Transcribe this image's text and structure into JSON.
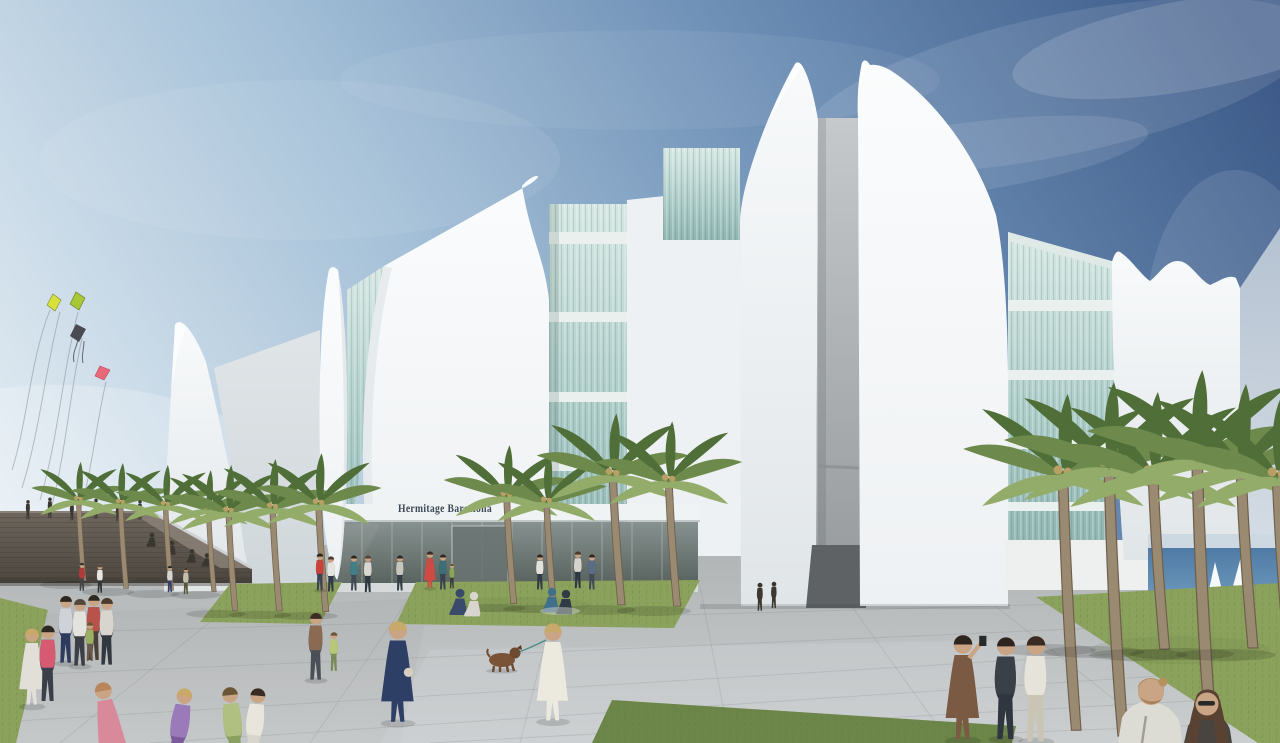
{
  "scene": {
    "type": "architectural-rendering",
    "description": "Architectural rendering of the Hermitage Barcelona museum: white sail-like shells alternating with green glass curtain walls, a palm-lined stone plaza with pedestrians, kites flying at left and the sea with sailboats at right.",
    "building": {
      "sign": "Hermitage Barcelona"
    },
    "details": {
      "kites": "two yellow-green kites, one dark kite, one pink kite with long tails",
      "sailboats": "two white sailboats on blue sea at right",
      "foreground": "woman in navy dress, woman in white dress walking a brown dog, children running, couple in lower right corner"
    }
  },
  "colors": {
    "sky_top": "#3d5a88",
    "sky_upper": "#6b8db4",
    "sky_mid": "#a3bfd7",
    "sky_low": "#e4edf3",
    "shell_light": "#f8fafb",
    "shell_mid": "#eef1f3",
    "shell_shade": "#e0e5e8",
    "shell_dark_side": "#cfd6d9",
    "glass_top": "#d6e7e3",
    "glass_mid": "#aecdc9",
    "glass_deep": "#8fb5b1",
    "slab": "#e9f0ed",
    "slot_top": "#c6c9cb",
    "slot_bottom": "#94989a",
    "recess_dark": "#5e6264",
    "entrance_top": "#87918f",
    "entrance_bottom": "#59635f",
    "fascia": "#f0f3f4",
    "sign_text": "#3c4854",
    "wall_top_c": "#6e665d",
    "wall_bottom_c": "#4c463f",
    "wall_light_edge": "#cfd2d4",
    "plaza_top_c": "#b0b4b5",
    "plaza_bottom_c": "#cbcecf",
    "joint": "#7e8486",
    "grass_main": "#8ba25c",
    "grass_shade": "#6c8549",
    "hedge": "#7d9055",
    "sea_top_c": "#4e7ba6",
    "sea_bottom_c": "#7099bc",
    "sail": "#f6f9fa",
    "haze_top": "#bdc9d6",
    "haze_bottom": "#dfe5ea",
    "palm_frond": "#6d8a4c",
    "palm_frond_dark": "#4f6e38",
    "palm_frond_light": "#93ac6a",
    "palm_trunk": "#9a8a72",
    "palm_trunk_dark": "#6e5f4c",
    "kite_yellow": "#d8e03c",
    "kite_green": "#a8c838",
    "kite_dark": "#4a4a52",
    "kite_pink": "#e86a7a",
    "string": "#8a8f98",
    "skin": "#c9a585"
  }
}
